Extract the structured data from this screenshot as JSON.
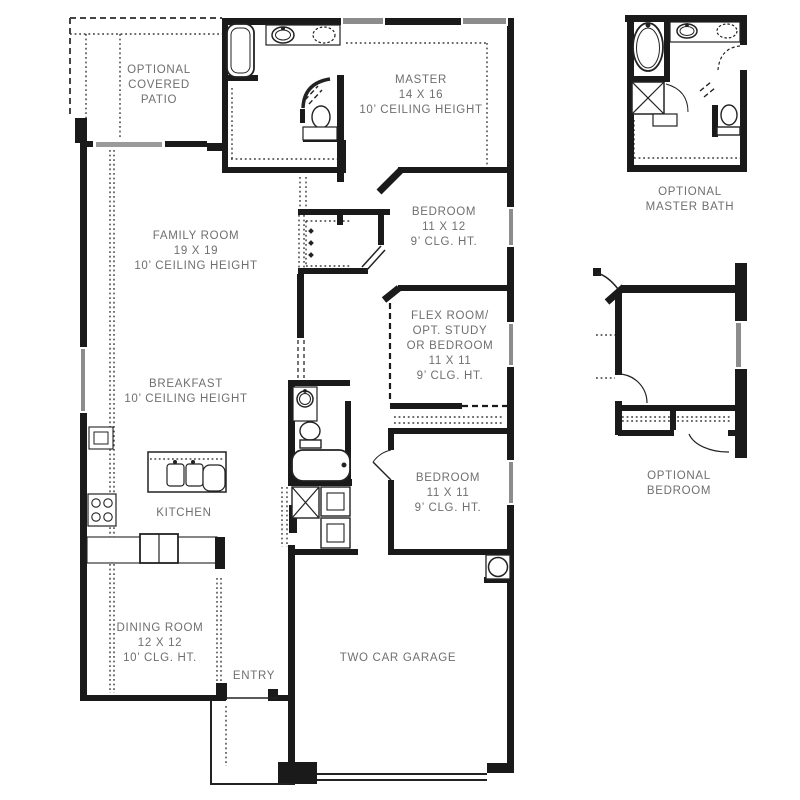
{
  "plan": {
    "background": "#ffffff",
    "wall_color": "#1a1a1a",
    "label_color": "#6f6f6f",
    "window_color": "#8c8c8c",
    "door_color": "#9a9a9a",
    "rooms": {
      "patio": [
        "OPTIONAL",
        "COVERED",
        "PATIO"
      ],
      "master": [
        "MASTER",
        "14 X 16",
        "10’ CEILING HEIGHT"
      ],
      "family": [
        "FAMILY ROOM",
        "19 X 19",
        "10’ CEILING HEIGHT"
      ],
      "bedroom2": [
        "BEDROOM",
        "11 X 12",
        "9’ CLG. HT."
      ],
      "flex": [
        "FLEX ROOM/",
        "OPT. STUDY",
        "OR BEDROOM",
        "11 X 11",
        "9’ CLG. HT."
      ],
      "breakfast": [
        "BREAKFAST",
        "10’ CEILING HEIGHT"
      ],
      "kitchen": [
        "KITCHEN"
      ],
      "bedroom3": [
        "BEDROOM",
        "11 X 11",
        "9’ CLG. HT."
      ],
      "dining": [
        "DINING ROOM",
        "12 X 12",
        "10’ CLG. HT."
      ],
      "entry": [
        "ENTRY"
      ],
      "garage": [
        "TWO CAR GARAGE"
      ],
      "opt_master_bath": [
        "OPTIONAL",
        "MASTER BATH"
      ],
      "opt_bedroom": [
        "OPTIONAL",
        "BEDROOM"
      ]
    }
  }
}
